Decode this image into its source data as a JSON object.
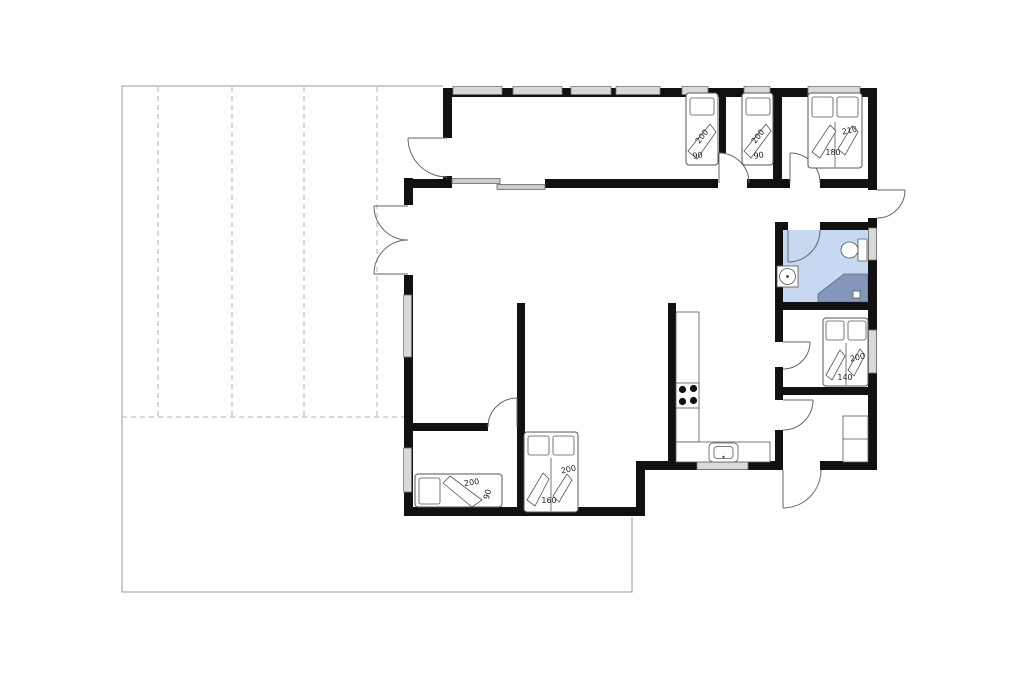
{
  "plan": {
    "type": "holiday-house-floor-plan",
    "colors": {
      "wall": "#111111",
      "window": "#d9d9d9",
      "bathroom": "#c6d9f0",
      "shower": "#8497bb",
      "line": "#666666",
      "terrace": "#9a9a9a"
    },
    "fixtures": [
      "stove",
      "sink",
      "toilet",
      "shower",
      "floor-drain",
      "wardrobe",
      "beds",
      "terrace"
    ],
    "labels": [
      {
        "id": "bedroom1-bed-length",
        "text": "200"
      },
      {
        "id": "bedroom1-bed-width",
        "text": "90"
      },
      {
        "id": "bedroom2-bed-length",
        "text": "200"
      },
      {
        "id": "bedroom2-bed-width",
        "text": "90"
      },
      {
        "id": "bedroom3-bed-length",
        "text": "210"
      },
      {
        "id": "bedroom3-bed-width",
        "text": "180"
      },
      {
        "id": "bedroom4-bed-length",
        "text": "200"
      },
      {
        "id": "bedroom4-bed-width",
        "text": "140"
      },
      {
        "id": "alcove-bed-length",
        "text": "200"
      },
      {
        "id": "alcove-bed-width",
        "text": "160"
      },
      {
        "id": "small-bedroom-bed-length",
        "text": "200"
      },
      {
        "id": "small-bedroom-bed-width",
        "text": "90"
      }
    ]
  }
}
